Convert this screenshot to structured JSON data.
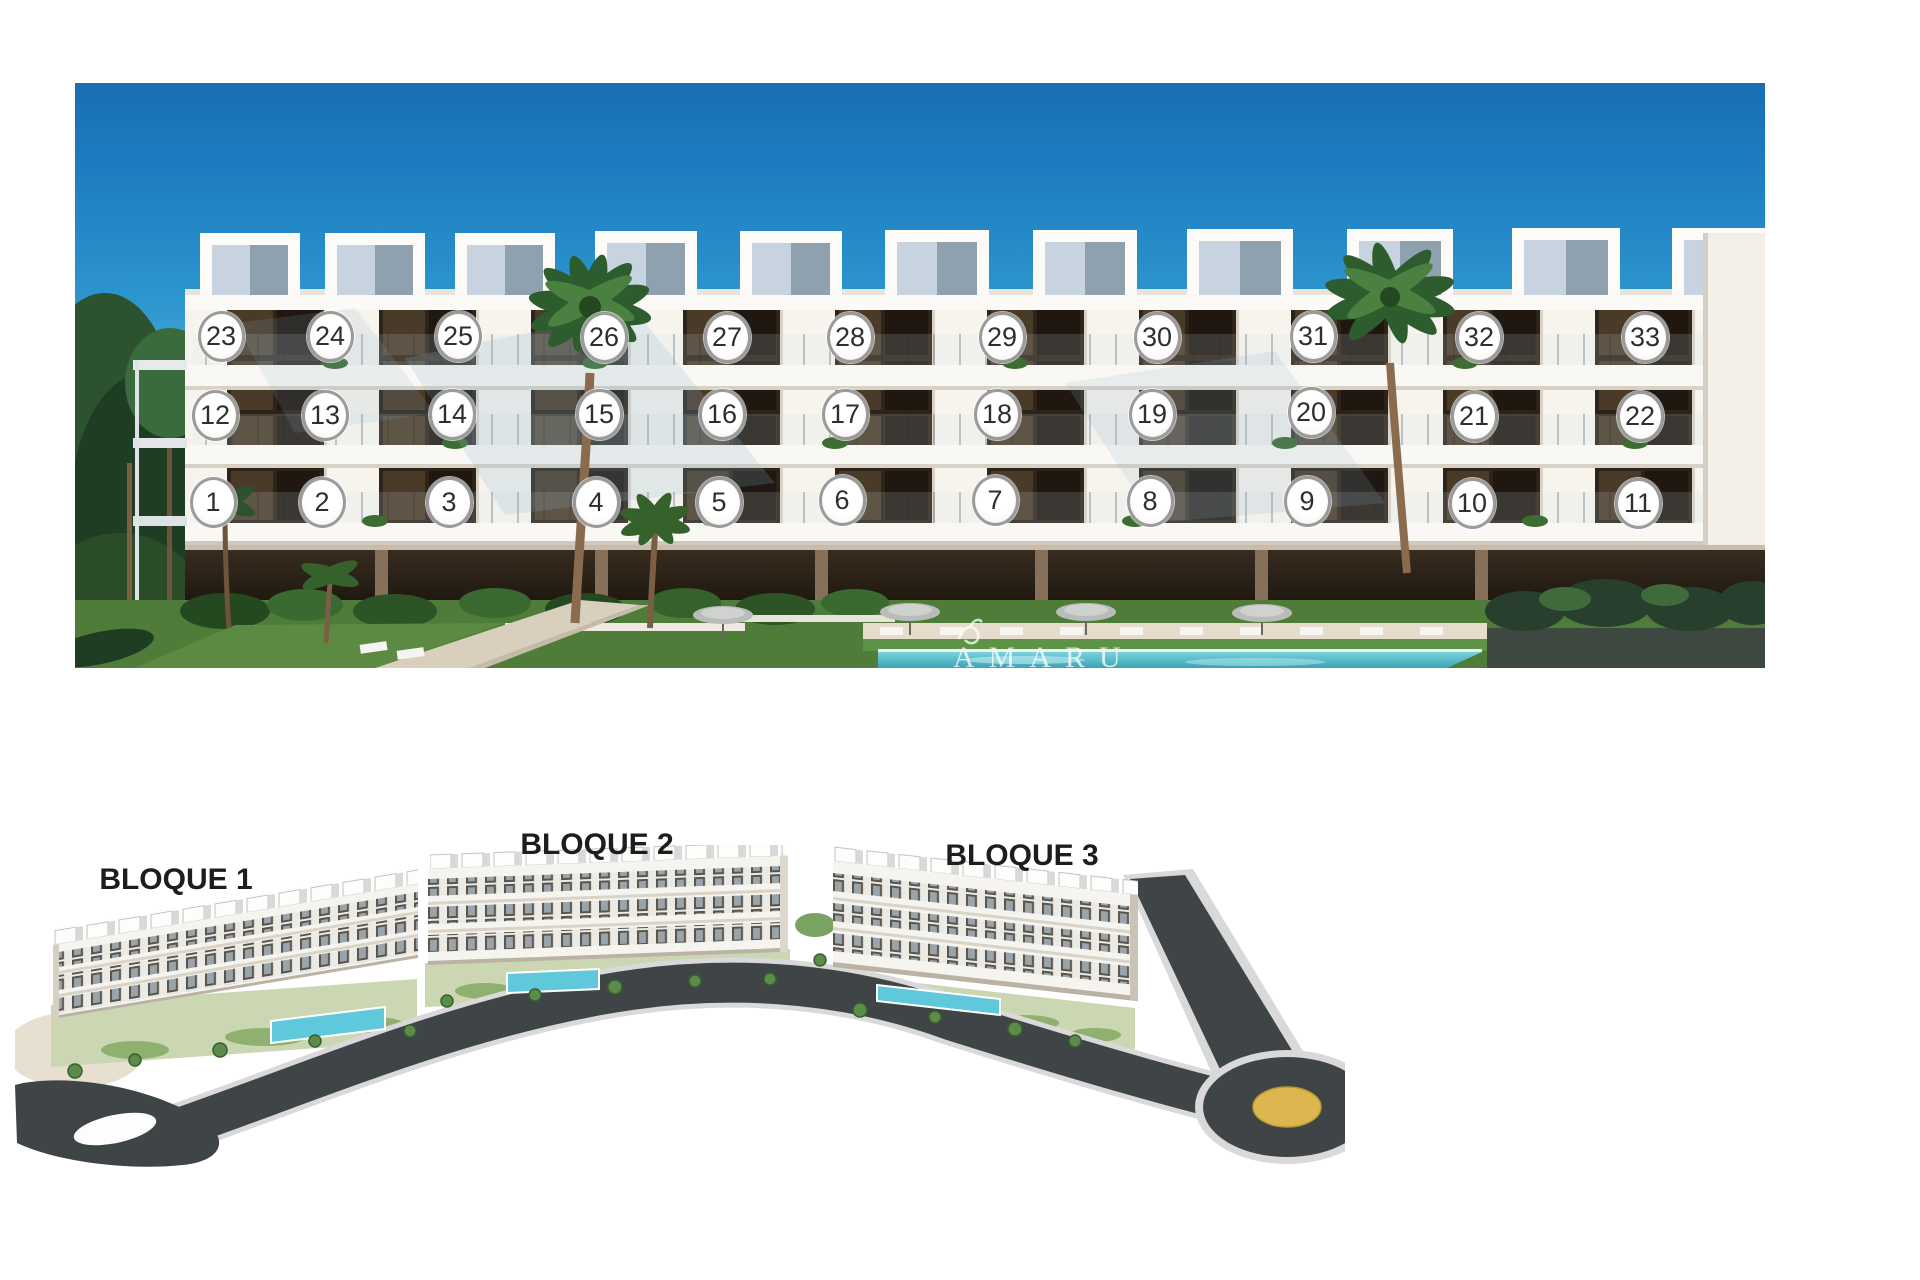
{
  "top_photo": {
    "description": "facade-render-with-unit-numbers",
    "watermark": "AMARU",
    "units": [
      {
        "label": "1",
        "x": 213,
        "y": 502
      },
      {
        "label": "2",
        "x": 322,
        "y": 502
      },
      {
        "label": "3",
        "x": 449,
        "y": 502
      },
      {
        "label": "4",
        "x": 596,
        "y": 502
      },
      {
        "label": "5",
        "x": 719,
        "y": 502
      },
      {
        "label": "6",
        "x": 842,
        "y": 500
      },
      {
        "label": "7",
        "x": 995,
        "y": 500
      },
      {
        "label": "8",
        "x": 1150,
        "y": 501
      },
      {
        "label": "9",
        "x": 1307,
        "y": 501
      },
      {
        "label": "10",
        "x": 1472,
        "y": 503
      },
      {
        "label": "11",
        "x": 1638,
        "y": 503
      },
      {
        "label": "12",
        "x": 215,
        "y": 415
      },
      {
        "label": "13",
        "x": 325,
        "y": 415
      },
      {
        "label": "14",
        "x": 452,
        "y": 414
      },
      {
        "label": "15",
        "x": 599,
        "y": 414
      },
      {
        "label": "16",
        "x": 722,
        "y": 414
      },
      {
        "label": "17",
        "x": 845,
        "y": 414
      },
      {
        "label": "18",
        "x": 997,
        "y": 414
      },
      {
        "label": "19",
        "x": 1152,
        "y": 414
      },
      {
        "label": "20",
        "x": 1311,
        "y": 412
      },
      {
        "label": "21",
        "x": 1474,
        "y": 416
      },
      {
        "label": "22",
        "x": 1640,
        "y": 416
      },
      {
        "label": "23",
        "x": 221,
        "y": 336
      },
      {
        "label": "24",
        "x": 330,
        "y": 336
      },
      {
        "label": "25",
        "x": 458,
        "y": 336
      },
      {
        "label": "26",
        "x": 604,
        "y": 337
      },
      {
        "label": "27",
        "x": 727,
        "y": 337
      },
      {
        "label": "28",
        "x": 850,
        "y": 337
      },
      {
        "label": "29",
        "x": 1002,
        "y": 337
      },
      {
        "label": "30",
        "x": 1157,
        "y": 337
      },
      {
        "label": "31",
        "x": 1313,
        "y": 336
      },
      {
        "label": "32",
        "x": 1479,
        "y": 337
      },
      {
        "label": "33",
        "x": 1645,
        "y": 337
      }
    ]
  },
  "site_plan": {
    "labels": [
      {
        "text": "BLOQUE 1"
      },
      {
        "text": "BLOQUE 2"
      },
      {
        "text": "BLOQUE 3"
      }
    ]
  },
  "colors": {
    "sky_top": "#1a6eb4",
    "sky_low": "#cfeaf5",
    "facade": "#f6f2ec",
    "window_dark": "#2d2318",
    "pool": "#4ab6c6",
    "lawn": "#4f7d39",
    "hedge_block": "#3d4841",
    "road": "#3f4447",
    "roundabout_yellow": "#ddb64f",
    "marker_ring": "#9b9b9b"
  }
}
